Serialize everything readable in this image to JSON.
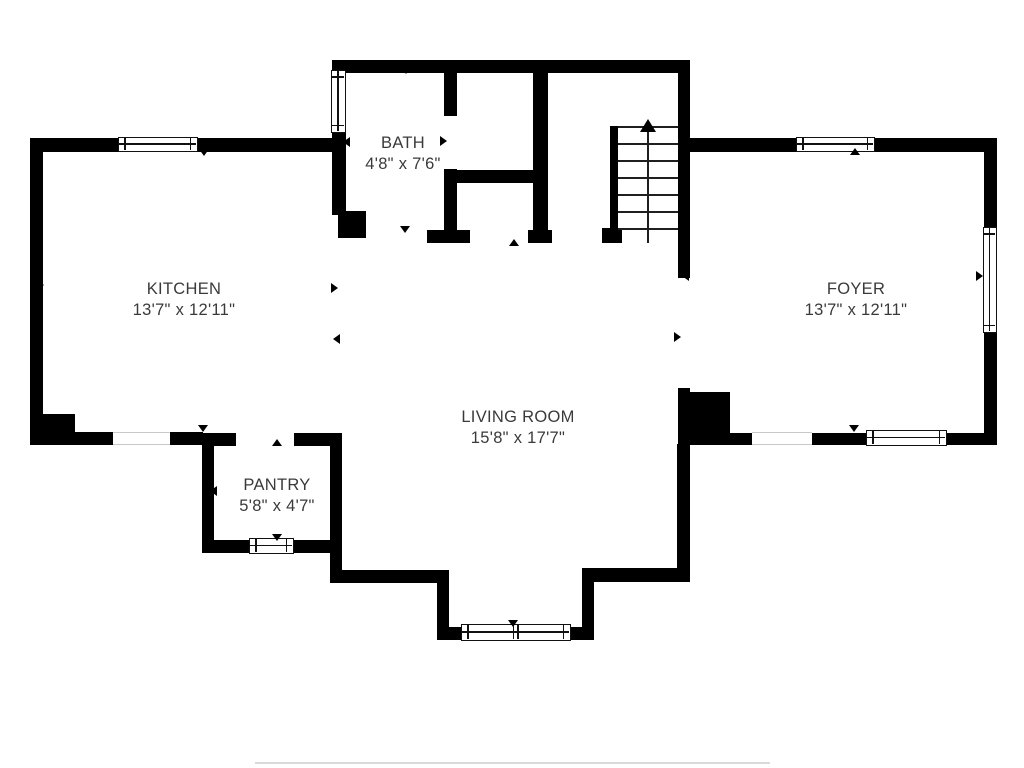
{
  "title": "First floor plan",
  "colors": {
    "background": "#ffffff",
    "wall": "#000000",
    "text": "#3a3a3a",
    "window_border": "#111111",
    "door_line": "#c9c9c9",
    "stair_tread": "#1f1f1f",
    "artifact_line": "#dadada"
  },
  "rooms": [
    {
      "name": "BATH",
      "dims": "4'8\" x 7'6\"",
      "cx": 403,
      "cy": 154
    },
    {
      "name": "KITCHEN",
      "dims": "13'7\" x 12'11\"",
      "cx": 184,
      "cy": 300
    },
    {
      "name": "FOYER",
      "dims": "13'7\" x 12'11\"",
      "cx": 856,
      "cy": 300
    },
    {
      "name": "LIVING ROOM",
      "dims": "15'8\" x 17'7\"",
      "cx": 518,
      "cy": 428
    },
    {
      "name": "PANTRY",
      "dims": "5'8\" x 4'7\"",
      "cx": 277,
      "cy": 496
    }
  ],
  "geometry": {
    "walls": [
      [
        335,
        60,
        355,
        13
      ],
      [
        332,
        60,
        14,
        14
      ],
      [
        332,
        131,
        14,
        84
      ],
      [
        338,
        211,
        28,
        27
      ],
      [
        444,
        60,
        13,
        56
      ],
      [
        444,
        169,
        13,
        74
      ],
      [
        444,
        170,
        101,
        13
      ],
      [
        533,
        60,
        15,
        183
      ],
      [
        427,
        230,
        43,
        13
      ],
      [
        528,
        230,
        24,
        13
      ],
      [
        30,
        138,
        315,
        14
      ],
      [
        30,
        138,
        13,
        307
      ],
      [
        30,
        414,
        45,
        22
      ],
      [
        30,
        432,
        84,
        13
      ],
      [
        170,
        432,
        33,
        13
      ],
      [
        202,
        433,
        12,
        120
      ],
      [
        202,
        433,
        34,
        13
      ],
      [
        294,
        433,
        48,
        13
      ],
      [
        330,
        433,
        12,
        121
      ],
      [
        202,
        540,
        140,
        13
      ],
      [
        330,
        540,
        12,
        43
      ],
      [
        330,
        570,
        119,
        13
      ],
      [
        437,
        570,
        12,
        70
      ],
      [
        437,
        627,
        157,
        13
      ],
      [
        582,
        570,
        12,
        70
      ],
      [
        582,
        568,
        108,
        14
      ],
      [
        677,
        444,
        13,
        138
      ],
      [
        678,
        60,
        12,
        218
      ],
      [
        678,
        388,
        12,
        57
      ],
      [
        690,
        392,
        40,
        42
      ],
      [
        678,
        433,
        74,
        12
      ],
      [
        812,
        433,
        56,
        12
      ],
      [
        946,
        433,
        51,
        12
      ],
      [
        688,
        138,
        309,
        14
      ],
      [
        984,
        140,
        13,
        90
      ],
      [
        984,
        331,
        13,
        114
      ],
      [
        610,
        126,
        8,
        104
      ],
      [
        602,
        228,
        20,
        15
      ]
    ],
    "windows": [
      {
        "x": 118,
        "y": 137,
        "w": 80,
        "h": 15,
        "dir": "h",
        "double": false
      },
      {
        "x": 331,
        "y": 70,
        "w": 15,
        "h": 63,
        "dir": "v",
        "double": false
      },
      {
        "x": 796,
        "y": 137,
        "w": 79,
        "h": 15,
        "dir": "h",
        "double": false
      },
      {
        "x": 983,
        "y": 227,
        "w": 14,
        "h": 106,
        "dir": "v",
        "double": false
      },
      {
        "x": 866,
        "y": 430,
        "w": 81,
        "h": 16,
        "dir": "h",
        "double": false
      },
      {
        "x": 249,
        "y": 538,
        "w": 45,
        "h": 16,
        "dir": "h",
        "double": false
      },
      {
        "x": 461,
        "y": 624,
        "w": 110,
        "h": 17,
        "dir": "h",
        "double": true
      }
    ],
    "doors": [
      {
        "x": 113,
        "y": 432,
        "w": 57,
        "h": 13
      },
      {
        "x": 752,
        "y": 432,
        "w": 60,
        "h": 13
      }
    ],
    "markers": [
      {
        "cx": 204,
        "cy": 154,
        "dir": "down"
      },
      {
        "cx": 42,
        "cy": 285,
        "dir": "right"
      },
      {
        "cx": 336,
        "cy": 288,
        "dir": "right"
      },
      {
        "cx": 338,
        "cy": 339,
        "dir": "left"
      },
      {
        "cx": 203,
        "cy": 430,
        "dir": "down"
      },
      {
        "cx": 277,
        "cy": 444,
        "dir": "up"
      },
      {
        "cx": 215,
        "cy": 491,
        "dir": "left"
      },
      {
        "cx": 335,
        "cy": 491,
        "dir": "right"
      },
      {
        "cx": 277,
        "cy": 539,
        "dir": "down"
      },
      {
        "cx": 406,
        "cy": 72,
        "dir": "down"
      },
      {
        "cx": 405,
        "cy": 231,
        "dir": "down"
      },
      {
        "cx": 348,
        "cy": 142,
        "dir": "left"
      },
      {
        "cx": 445,
        "cy": 141,
        "dir": "right"
      },
      {
        "cx": 514,
        "cy": 244,
        "dir": "up"
      },
      {
        "cx": 687,
        "cy": 276,
        "dir": "left"
      },
      {
        "cx": 679,
        "cy": 337,
        "dir": "right"
      },
      {
        "cx": 855,
        "cy": 153,
        "dir": "up"
      },
      {
        "cx": 854,
        "cy": 430,
        "dir": "down"
      },
      {
        "cx": 981,
        "cy": 276,
        "dir": "right"
      },
      {
        "cx": 513,
        "cy": 625,
        "dir": "down"
      }
    ],
    "stairs": {
      "x": 618,
      "y": 126,
      "w": 60,
      "tread_count": 7,
      "tread_spacing": 17,
      "line_x": 647,
      "line_top": 128,
      "line_bottom": 243,
      "arrow_left": 640,
      "arrow_top": 119
    },
    "artifact_line": {
      "x": 255,
      "y": 762,
      "w": 515,
      "h": 2
    }
  }
}
